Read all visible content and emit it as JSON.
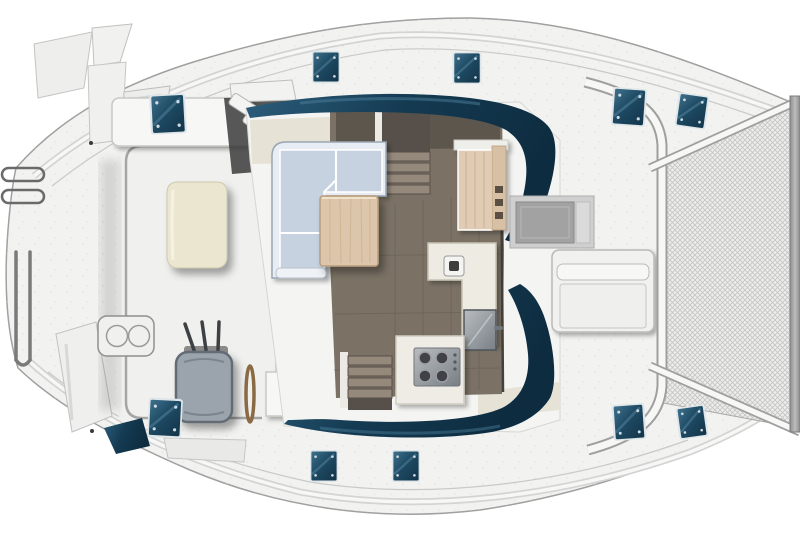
{
  "visible_text": "",
  "image": {
    "kind": "top-down floor plan illustration of a catamaran yacht deck",
    "orientation": "bow at right (cropped at edge), stern with swim platforms at left",
    "sections": {
      "aft_cockpit": [
        "cockpit dining table (cream)",
        "forward bench seat",
        "helm seat (gray upholstery)",
        "throttle levers",
        "steering wheel (edge view)",
        "wet-bar module",
        "twin-burner grill",
        "flybridge steps"
      ],
      "salon": [
        "L-shaped sofa (light blue cushions)",
        "wooden coffee table",
        "companionway stairs forward",
        "companionway stairs aft",
        "wood fridge cabinet",
        "L-shaped galley counter with sink",
        "stainless stove with 4 burners",
        "stainless fridge door",
        "dark wraparound window bands"
      ],
      "foredeck": [
        "recessed deck hatch",
        "storage locker with lid"
      ],
      "bow": [
        "trampoline net",
        "crossbeam",
        "bowsprit strip (cropped)"
      ],
      "deck": [
        "10 blue deck hatches",
        "stern swim steps",
        "stern rails",
        "swim ladder"
      ]
    },
    "hatch_count": 10
  },
  "colors": {
    "deck": "#f2f2f1",
    "hull_stroke": "#a0a0a0",
    "gunwale": "#d4d4d4",
    "white": "#f7f7f6",
    "window_dark": "#123348",
    "window_mid": "#1e4a63",
    "window_light": "#41738f",
    "hatch_frame": "#dfe6e9",
    "floor": "#7b7265",
    "floor_line": "#665d51",
    "floor_dark": "#5d564d",
    "sofa_seat": "#c6d2e0",
    "sofa_back": "#e8edf3",
    "sofa_stroke": "#9aa6b4",
    "wood": "#dcc6ab",
    "wood_dark": "#b99d7c",
    "cream": "#eae6cf",
    "cream_stroke": "#cfcab0",
    "counter": "#edebe2",
    "counter_stroke": "#c7c3b5",
    "cabinet_cream": "#e6e2d6",
    "steel": "#9aa0a6",
    "steel_dark": "#565c62",
    "seat_gray": "#9ba3ac",
    "seat_gray_dark": "#646c74",
    "step": "#94897b",
    "step_dark": "#57504a",
    "mesh_bg": "#ededec",
    "mesh_line": "#c5c5c5"
  }
}
